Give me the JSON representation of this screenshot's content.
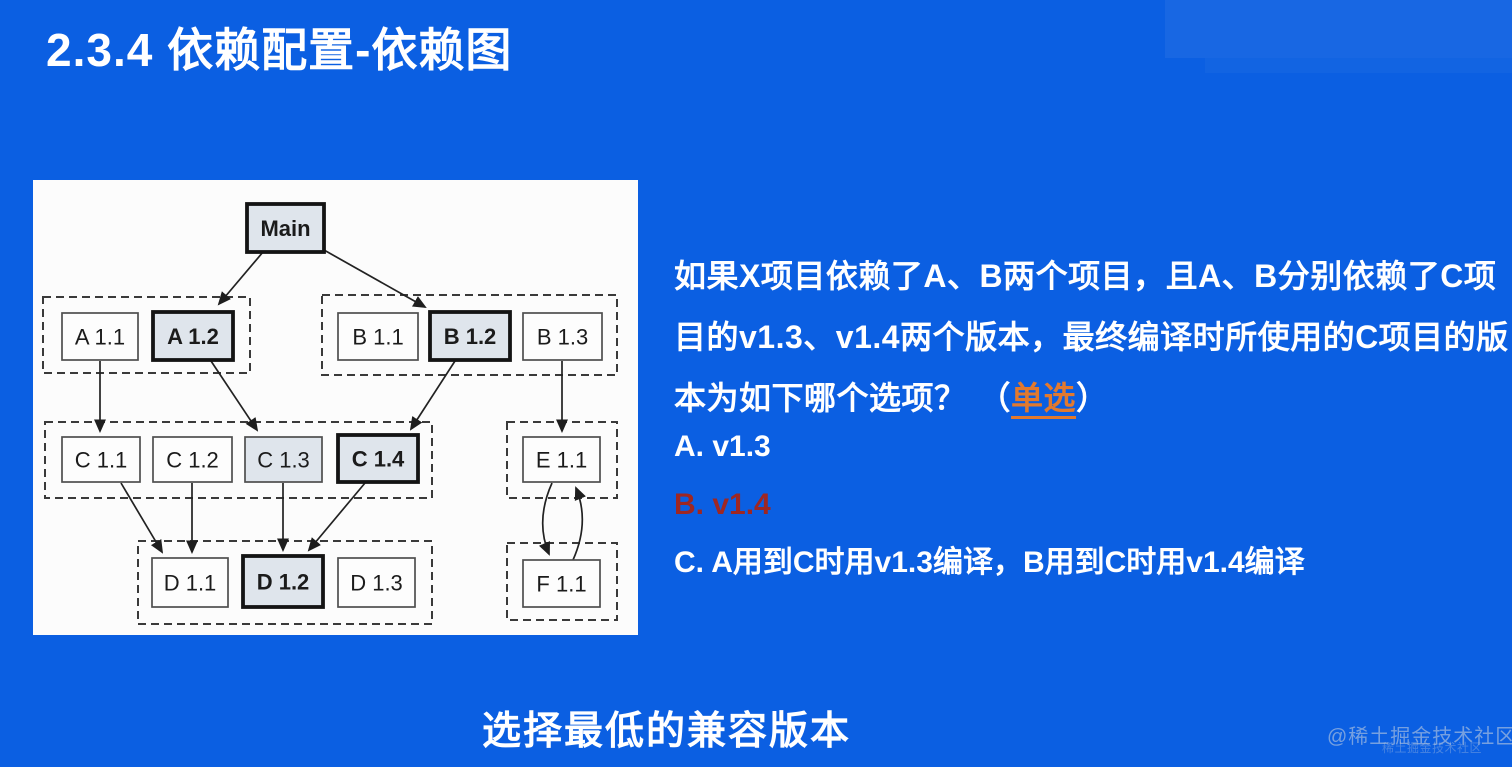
{
  "title": "2.3.4 依赖配置-依赖图",
  "colors": {
    "background": "#0b5fe2",
    "panel": "#fcfcfc",
    "node_tint_fill": "#dfe5ec",
    "highlight_border": "#141414",
    "tag_orange": "#e2792e",
    "answer_red": "#9e2723",
    "watermark_gray": "#becbe0"
  },
  "diagram": {
    "groups": [
      {
        "x": 10,
        "y": 117,
        "w": 207,
        "h": 76
      },
      {
        "x": 289,
        "y": 115,
        "w": 295,
        "h": 80
      },
      {
        "x": 12,
        "y": 242,
        "w": 387,
        "h": 76
      },
      {
        "x": 474,
        "y": 242,
        "w": 110,
        "h": 76
      },
      {
        "x": 105,
        "y": 361,
        "w": 294,
        "h": 83
      },
      {
        "x": 474,
        "y": 363,
        "w": 110,
        "h": 77
      }
    ],
    "nodes": [
      {
        "id": "main",
        "label": "Main",
        "x": 214,
        "y": 24,
        "w": 77,
        "h": 48,
        "style": "bold"
      },
      {
        "id": "a11",
        "label": "A 1.1",
        "x": 29,
        "y": 133,
        "w": 76,
        "h": 47,
        "style": "plain"
      },
      {
        "id": "a12",
        "label": "A 1.2",
        "x": 120,
        "y": 132,
        "w": 80,
        "h": 48,
        "style": "bold"
      },
      {
        "id": "b11",
        "label": "B 1.1",
        "x": 305,
        "y": 133,
        "w": 80,
        "h": 47,
        "style": "plain"
      },
      {
        "id": "b12",
        "label": "B 1.2",
        "x": 397,
        "y": 132,
        "w": 80,
        "h": 48,
        "style": "bold"
      },
      {
        "id": "b13",
        "label": "B 1.3",
        "x": 490,
        "y": 133,
        "w": 79,
        "h": 47,
        "style": "plain"
      },
      {
        "id": "c11",
        "label": "C 1.1",
        "x": 29,
        "y": 257,
        "w": 78,
        "h": 45,
        "style": "plain"
      },
      {
        "id": "c12",
        "label": "C 1.2",
        "x": 120,
        "y": 257,
        "w": 79,
        "h": 45,
        "style": "plain"
      },
      {
        "id": "c13",
        "label": "C 1.3",
        "x": 212,
        "y": 257,
        "w": 77,
        "h": 45,
        "style": "tint"
      },
      {
        "id": "c14",
        "label": "C 1.4",
        "x": 305,
        "y": 255,
        "w": 80,
        "h": 47,
        "style": "bold"
      },
      {
        "id": "e11",
        "label": "E 1.1",
        "x": 490,
        "y": 257,
        "w": 77,
        "h": 45,
        "style": "plain"
      },
      {
        "id": "d11",
        "label": "D 1.1",
        "x": 119,
        "y": 378,
        "w": 76,
        "h": 49,
        "style": "plain"
      },
      {
        "id": "d12",
        "label": "D 1.2",
        "x": 210,
        "y": 376,
        "w": 80,
        "h": 51,
        "style": "bold"
      },
      {
        "id": "d13",
        "label": "D 1.3",
        "x": 305,
        "y": 378,
        "w": 77,
        "h": 49,
        "style": "plain"
      },
      {
        "id": "f11",
        "label": "F 1.1",
        "x": 490,
        "y": 380,
        "w": 77,
        "h": 47,
        "style": "plain"
      }
    ],
    "edges": [
      {
        "x1": 230,
        "y1": 72,
        "x2": 186,
        "y2": 124
      },
      {
        "x1": 291,
        "y1": 70,
        "x2": 392,
        "y2": 127
      },
      {
        "x1": 67,
        "y1": 181,
        "x2": 67,
        "y2": 251
      },
      {
        "x1": 178,
        "y1": 181,
        "x2": 224,
        "y2": 250
      },
      {
        "x1": 422,
        "y1": 181,
        "x2": 378,
        "y2": 249
      },
      {
        "x1": 529,
        "y1": 181,
        "x2": 529,
        "y2": 251
      },
      {
        "x1": 88,
        "y1": 303,
        "x2": 129,
        "y2": 372
      },
      {
        "x1": 159,
        "y1": 303,
        "x2": 159,
        "y2": 372
      },
      {
        "x1": 250,
        "y1": 303,
        "x2": 250,
        "y2": 370
      },
      {
        "x1": 332,
        "y1": 303,
        "x2": 276,
        "y2": 370
      },
      {
        "x1": 519,
        "y1": 303,
        "qx": 502,
        "qy": 341,
        "x2": 516,
        "y2": 374
      },
      {
        "x1": 540,
        "y1": 380,
        "qx": 557,
        "qy": 342,
        "x2": 543,
        "y2": 308
      }
    ]
  },
  "question": {
    "lines": [
      "如果X项目依赖了A、B两个项目，且A、B分别依赖了C项",
      "目的v1.3、v1.4两个版本，最终编译时所使用的C项目的版",
      "本为如下哪个选项？"
    ],
    "tag_open": "（",
    "tag": "单选",
    "tag_close": "）",
    "options": [
      {
        "label": "A. v1.3",
        "highlight": false
      },
      {
        "label": "B. v1.4",
        "highlight": true
      },
      {
        "label": "C. A用到C时用v1.3编译，B用到C时用v1.4编译",
        "highlight": false
      }
    ]
  },
  "footer": {
    "caption": "选择最低的兼容版本"
  },
  "watermark": {
    "text": "@稀土掘金技术社区",
    "echo": "稀土掘金技术社区"
  }
}
